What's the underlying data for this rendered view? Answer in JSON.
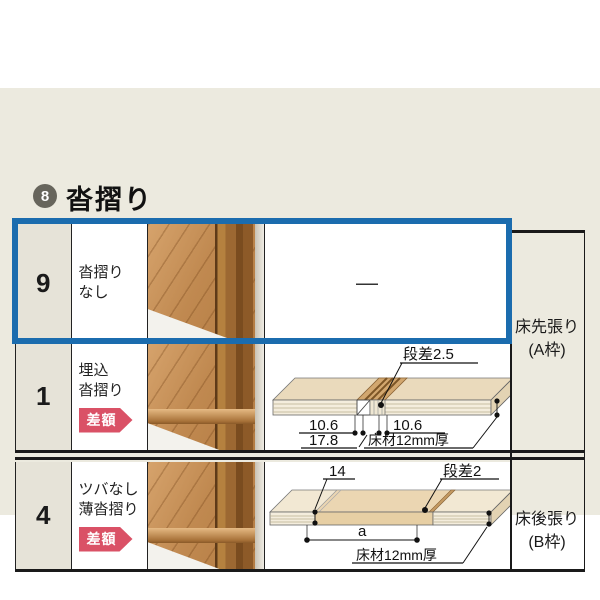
{
  "header": {
    "number": "8",
    "title": "沓摺り"
  },
  "colors": {
    "panel_bg": "#ECEADF",
    "highlight_blue": "#1B6CAE",
    "badge_pink": "#DA5166",
    "number_cell_bg": "#E6E3D8",
    "header_circle": "#67655C"
  },
  "rows": [
    {
      "num": "9",
      "label1": "沓摺り",
      "label2": "なし",
      "value": "—",
      "photo": "wood-flooring-at-door-frame"
    },
    {
      "num": "1",
      "label1": "埋込",
      "label2": "沓摺り",
      "badge": "差額",
      "photo": "wood-flooring-embedded-sill"
    },
    {
      "num": "4",
      "label1": "ツバなし",
      "label2": "薄沓摺り",
      "badge": "差額",
      "photo": "wood-flooring-thin-sill"
    }
  ],
  "side_labels": {
    "a1": "床先張り",
    "a2": "(A枠)",
    "b1": "床後張り",
    "b2": "(B枠)"
  },
  "diagram1": {
    "step_label": "段差2.5",
    "dim_left": "10.6",
    "dim_right": "10.6",
    "dim_total": "17.8",
    "floor_label": "床材12mm厚"
  },
  "diagram2": {
    "dim_width": "14",
    "step_label": "段差2",
    "dim_a": "a",
    "floor_label": "床材12mm厚"
  }
}
